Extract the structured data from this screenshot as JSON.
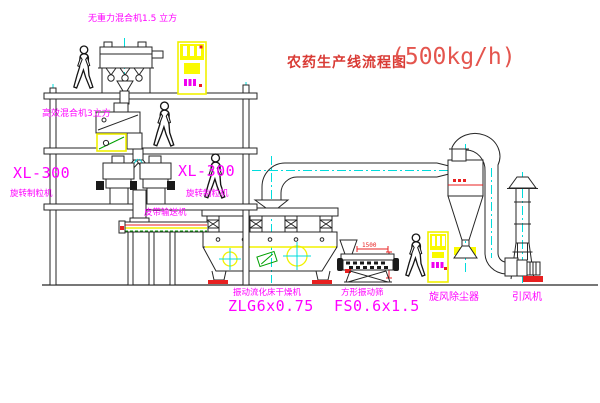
{
  "title": {
    "name": "农药生产线流程图",
    "capacity": "(500kg/h)"
  },
  "equipment_labels": {
    "gravity_mixer": "无重力混合机1.5 立方",
    "mixer_3m3": "高效混合机3立方",
    "granulator_left_model": "XL-300",
    "granulator_left_name": "旋转制粒机",
    "granulator_mid_model": "XL-300",
    "granulator_mid_name": "旋转制粒机",
    "belt_conveyor": "皮带输送机",
    "dryer_name": "振动流化床干燥机",
    "dryer_model": "ZLG6x0.75",
    "sieve_name": "方形振动筛",
    "sieve_model": "FS0.6x1.5",
    "cyclone": "旋风除尘器",
    "fan": "引风机"
  },
  "dimensions": {
    "sieve_width": "1500"
  },
  "colors": {
    "label_magenta": "#ff00ff",
    "title_red": "#d93b35",
    "centerline_cyan": "#00dcdc",
    "highlight_yellow": "#fafa00",
    "accent_red": "#e82020",
    "accent_green": "#00a000",
    "line_black": "#262626"
  }
}
